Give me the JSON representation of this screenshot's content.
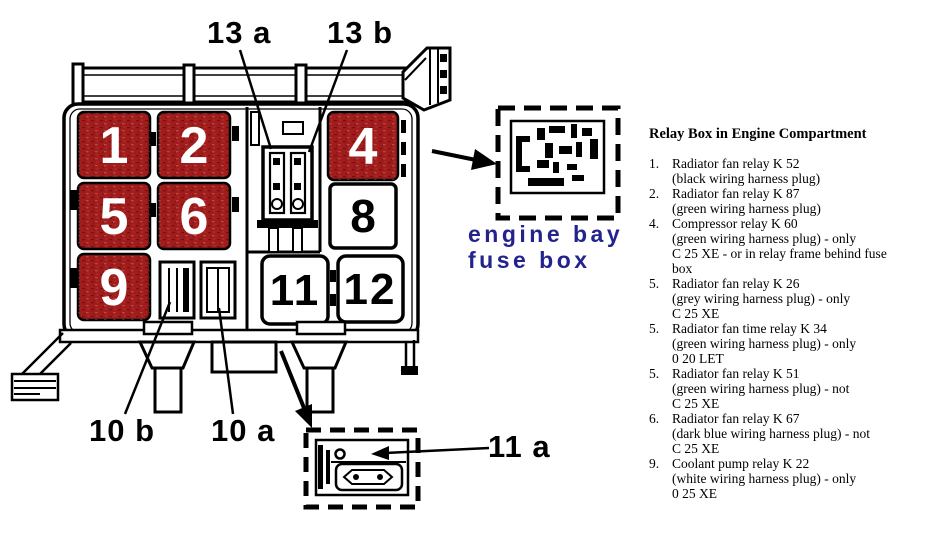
{
  "colors": {
    "relay_red": "#a31c1c",
    "caption_blue": "#23238e",
    "line_black": "#000000"
  },
  "diagram": {
    "relays": {
      "r1": "1",
      "r2": "2",
      "r4": "4",
      "r5": "5",
      "r6": "6",
      "r8": "8",
      "r9": "9",
      "r11": "11",
      "r12": "12"
    },
    "callouts": {
      "c13a": "13 a",
      "c13b": "13 b",
      "c10b": "10 b",
      "c10a": "10 a",
      "c11a": "11 a"
    },
    "caption": {
      "line1": "engine bay",
      "line2": "fuse box"
    }
  },
  "legend": {
    "title": "Relay Box in Engine Compartment",
    "items": [
      {
        "num": "1.",
        "lines": [
          "Radiator fan relay K 52",
          "(black wiring harness plug)"
        ]
      },
      {
        "num": "2.",
        "lines": [
          "Radiator fan relay K 87",
          "(green wiring harness plug)"
        ]
      },
      {
        "num": "4.",
        "lines": [
          "Compressor relay K 60",
          "(green wiring harness plug) - only",
          "C 25 XE - or in relay frame behind fuse",
          "box"
        ]
      },
      {
        "num": "5.",
        "lines": [
          "Radiator fan relay K 26",
          "(grey wiring harness plug) - only",
          "C 25 XE"
        ]
      },
      {
        "num": "5.",
        "lines": [
          "Radiator fan time relay K 34",
          "(green wiring harness plug) - only",
          "0 20 LET"
        ]
      },
      {
        "num": "5.",
        "lines": [
          "Radiator fan relay K 51",
          "(green wiring harness plug) - not",
          "C 25 XE"
        ]
      },
      {
        "num": "6.",
        "lines": [
          "Radiator fan relay K 67",
          "(dark blue wiring harness plug) - not",
          "C 25 XE"
        ]
      },
      {
        "num": "9.",
        "lines": [
          "Coolant pump relay K 22",
          "(white wiring harness plug) - only",
          "0 25 XE"
        ]
      }
    ]
  }
}
